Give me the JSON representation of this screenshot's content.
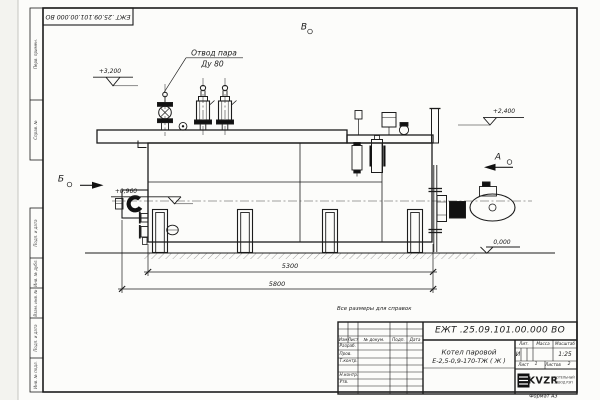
{
  "sheet": {
    "corner_stamp": "ЕЖТ .25.09.101.00.000 ВО",
    "format_note": "Формат А3",
    "reference_note": "Все размеры для справок",
    "margin_top": [
      {
        "label": "Перв. примен."
      },
      {
        "label": "Справ. №"
      }
    ],
    "margin_bottom": [
      {
        "label": "Подп. и дата"
      },
      {
        "label": "Инв. № дубл."
      },
      {
        "label": "Взам. инв. №"
      },
      {
        "label": "Подп. и дата"
      },
      {
        "label": "Инв. № подл."
      }
    ]
  },
  "drawing": {
    "callout_line1": "Отвод пара",
    "callout_line2": "Ду 80",
    "view_top": "В",
    "view_right": "А",
    "view_left": "Б",
    "elev_valves": "+3,200",
    "elev_top": "+2,400",
    "elev_burner": "+0,960",
    "elev_ground": "0,000",
    "dim_inner": "5300",
    "dim_overall": "5800"
  },
  "title_block": {
    "doc_number": "ЕЖТ .25.09.101.00.000 ВО",
    "name_line1": "Котел паровой",
    "name_line2": "Е-2,5-0,9-170-ТЖ ( Ж )",
    "col_izm": "Изм",
    "col_list": "Лист",
    "col_doc": "№ докум.",
    "col_sign": "Подп.",
    "col_date": "Дата",
    "role_razrab": "Разраб.",
    "role_prov": "Пров.",
    "role_tkontr": "Т.контр.",
    "role_nkontr": "Н.контр.",
    "role_utv": "Утв.",
    "lit_label": "Лит.",
    "lit_value": "И",
    "mass_label": "Масса",
    "scale_label": "Масштаб",
    "scale_value": "1:25",
    "sheet_label": "Лист",
    "sheet_value": "1",
    "sheets_label": "Листов",
    "sheets_value": "2",
    "logo_text": "KVZR",
    "logo_sub1": "КОТЕЛЬНЫЙ",
    "logo_sub2": "ЗАВОД РЭП"
  },
  "colors": {
    "line": "#1c1c1c",
    "paper": "#fcfcfa"
  }
}
